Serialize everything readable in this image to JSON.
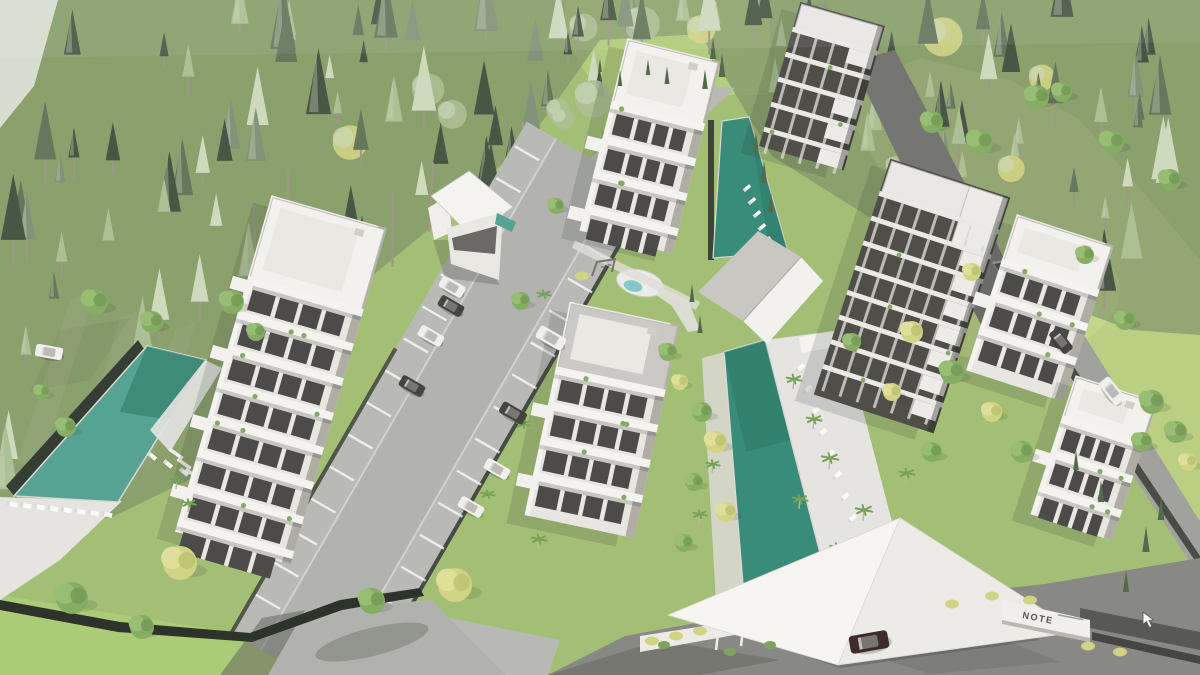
{
  "scene": {
    "description": "Aerial 3D architectural rendering of a hillside residential complex surrounded by pine forest, with apartment buildings, three swimming pools, parking lots, access roads, a splash pad playground and a white entrance canopy",
    "entrance_sign": {
      "text": "NOTE"
    },
    "objects": [
      "pine forest",
      "lawns",
      "apartment buildings",
      "swimming pools",
      "pool decks with sun loungers",
      "parking lot with cars",
      "access roads",
      "entrance canopy",
      "splash pad",
      "playground swing"
    ],
    "counts": {
      "buildings": 7,
      "pools": 3,
      "cars": 12
    },
    "palette": {
      "grass": "#9fbc6f",
      "grass_bright": "#aecb74",
      "grass_hill": "#b8cd7c",
      "grass_corner": "#a6ca70",
      "forest_floor": "#6d7f5e",
      "forest_dark": "#3f4f3c",
      "forest_mid": "#5d7055",
      "forest_gray": "#7c8d74",
      "forest_light": "#a8bd90",
      "forest_pale": "#ccd7bb",
      "tree_yellow": "#cfd27e",
      "tree_green": "#7fa95c",
      "trunk": "#9a9384",
      "pool_teal": "#2e8672",
      "pool_teal_deep": "#1f6f5d",
      "pool_teal_light": "#4f9f8e",
      "splash_blue": "#7fc3c9",
      "deck": "#e4e3e0",
      "road": "#b6b6b3",
      "road_dark": "#6e6e6b",
      "asphalt": "#82827e",
      "wall_dark": "#30352c",
      "building_white": "#f2f1ee",
      "building_light": "#e7e5e0",
      "building_shade": "#aca9a1",
      "building_dark": "#474540",
      "window_dark": "#434240",
      "canopy": "#f6f5f2",
      "canopy_shade": "#eceae6",
      "car_white": "#f0efed",
      "car_dark": "#3c3a38",
      "car_maroon": "#35201f",
      "sign_text_color": "#4a4a46"
    }
  }
}
